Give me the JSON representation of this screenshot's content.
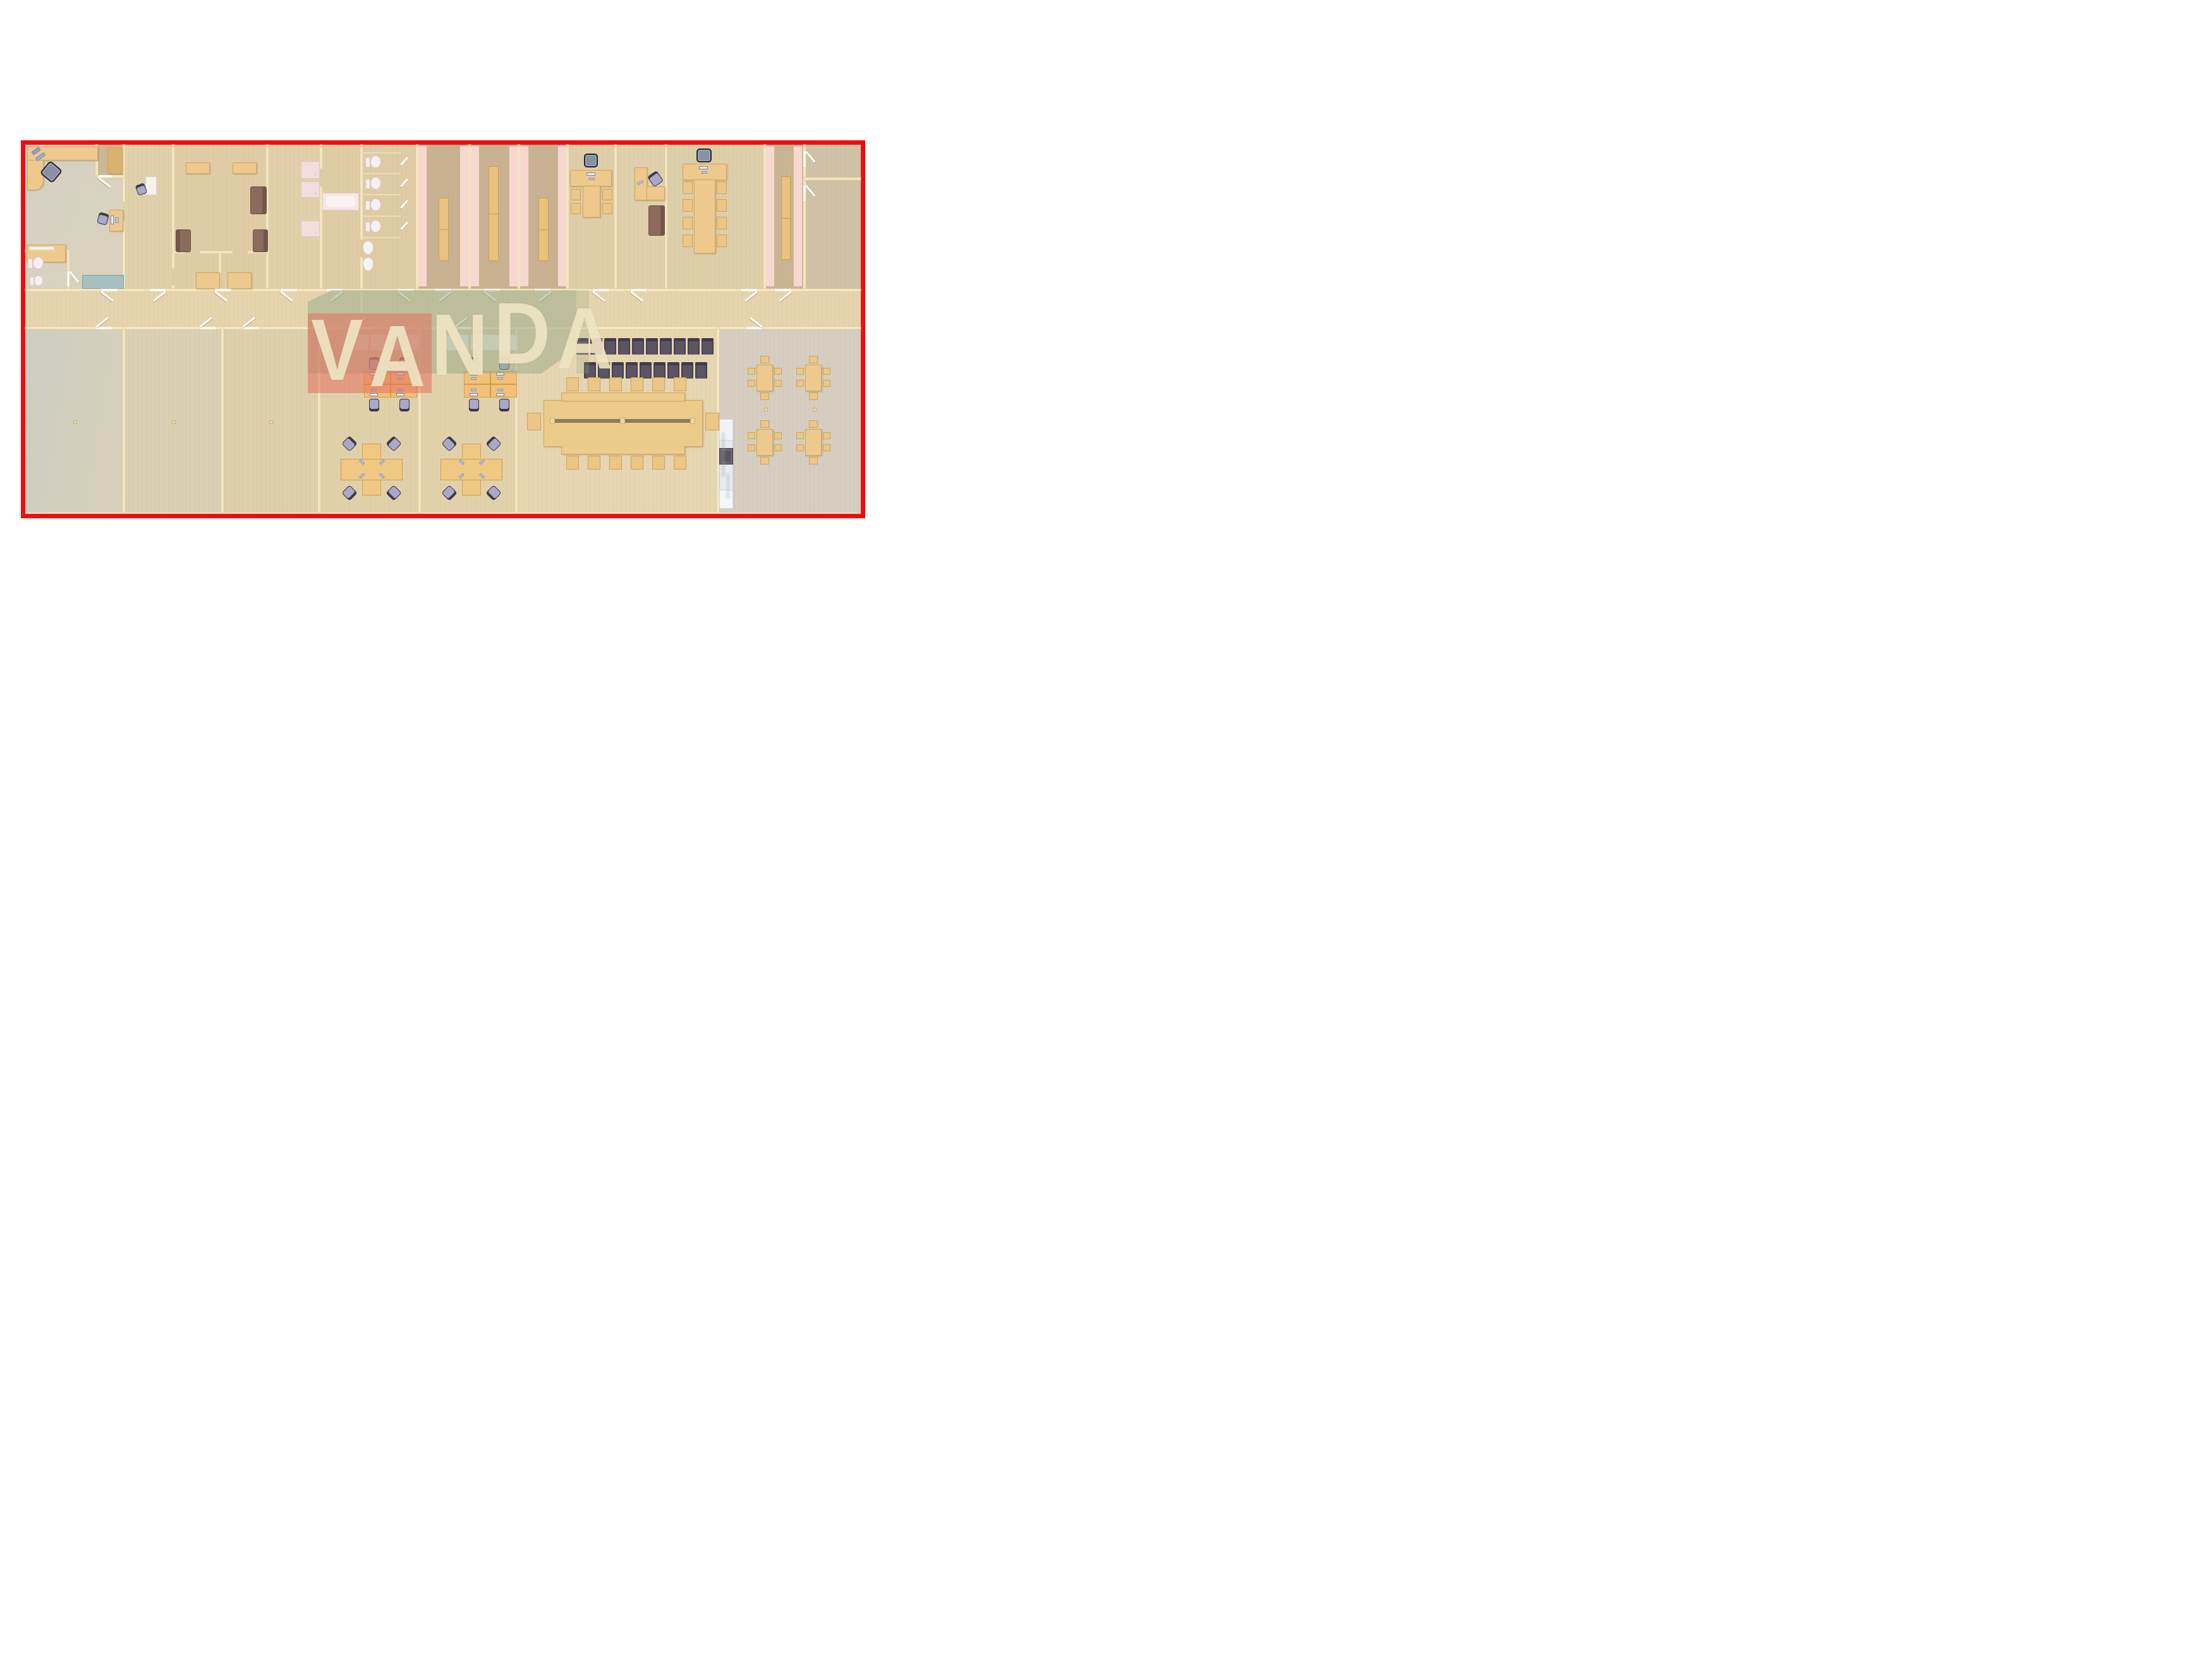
{
  "watermark": {
    "text": "VANDA",
    "letters": [
      "V",
      "A",
      "N",
      "D",
      "A"
    ]
  },
  "colors": {
    "border_red": "#ed0f0f",
    "wall_cream": "#f3e5c0",
    "floor_tan": "#e4d2ac",
    "floor_graygreen": "#d6d0c0",
    "locker_floor": "#c8b292",
    "locker_stripe_pink": "#f6d8cf",
    "watermark_red": "#e5705f",
    "watermark_sage": "#94a888",
    "watermark_letters": "#f0e5c4",
    "desk_wood": "#edc98e",
    "workstation_wood": "#f0c176",
    "chair_purple": "#aaa7c9",
    "chair_tan": "#eac786",
    "waiting_chair_dark": "#5a5463",
    "sofa_brown": "#8d6b5c",
    "credenza_white": "#f7ece1",
    "counter_silver": "#e7ebef",
    "appliance_dark": "#5a5462",
    "teal_cabinet": "#a7c0c1",
    "sanitary_pink": "#f2dede"
  },
  "floor_plan": {
    "type": "office-building-3d-top-view-floor-plan",
    "zones_top_row": [
      "executive-office",
      "closet",
      "small-office",
      "lounge",
      "lounge-room-1",
      "lounge-room-2",
      "shower-room",
      "bathroom",
      "toilet-block",
      "locker-room-1",
      "locker-room-2",
      "locker-room-3",
      "t-desk-office",
      "l-desk-office",
      "meeting-room",
      "locker-room-4",
      "storage-1",
      "storage-2"
    ],
    "zones_bottom_row": [
      "empty-room-1",
      "empty-room-2",
      "empty-room-3",
      "team-office-1",
      "team-office-2",
      "conference-hall",
      "canteen"
    ],
    "inventory": {
      "waiting_chair_rows": [
        10,
        9
      ],
      "conference_table_side_seats": 12,
      "conference_table_end_seats": 2,
      "meeting_table_seats": 9,
      "t_desk_office_seats": 5,
      "team_office_workstations_each": 8,
      "canteen_tables": 4,
      "canteen_seats_per_table": 6,
      "toilets": 5,
      "bidets": 1,
      "showers": 3,
      "sinks": 2,
      "bathtubs": 1,
      "locker_benches": 4,
      "sofas": 4
    }
  }
}
